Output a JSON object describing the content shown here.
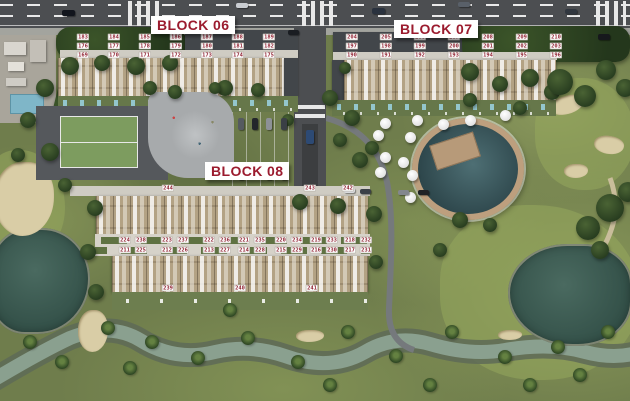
{
  "site": {
    "blocks": [
      {
        "id": "block-06",
        "label": "BLOCK 06",
        "unit_rows": [
          [
            "183",
            "184",
            "185",
            "186",
            "187",
            "188",
            "189"
          ],
          [
            "176",
            "177",
            "178",
            "179",
            "180",
            "181",
            "182"
          ],
          [
            "169",
            "170",
            "171",
            "172",
            "173",
            "174",
            "175"
          ]
        ]
      },
      {
        "id": "block-07",
        "label": "BLOCK 07",
        "unit_rows": [
          [
            "204",
            "205",
            "206",
            "207",
            "208",
            "209",
            "210"
          ],
          [
            "197",
            "198",
            "199",
            "200",
            "201",
            "202",
            "203"
          ],
          [
            "190",
            "191",
            "192",
            "193",
            "194",
            "195",
            "196"
          ]
        ]
      },
      {
        "id": "block-08",
        "label": "BLOCK 08",
        "top_end_units": [
          "244",
          "243",
          "242"
        ],
        "upper_pairs": [
          [
            "224",
            "238"
          ],
          [
            "223",
            "237"
          ],
          [
            "222",
            "236"
          ],
          [
            "221",
            "235"
          ],
          [
            "220",
            "234"
          ],
          [
            "219",
            "233"
          ],
          [
            "218",
            "232"
          ]
        ],
        "lower_pairs": [
          [
            "211",
            "225"
          ],
          [
            "212",
            "226"
          ],
          [
            "213",
            "227"
          ],
          [
            "214",
            "228"
          ],
          [
            "215",
            "229"
          ],
          [
            "216",
            "230"
          ],
          [
            "217",
            "231"
          ]
        ],
        "bottom_end_units": [
          "239",
          "240",
          "241"
        ]
      }
    ],
    "colors": {
      "unit_label_text": "#8e1f2f",
      "unit_label_bg": "#ffffff",
      "block_label_text": "#9b1b2e"
    }
  }
}
